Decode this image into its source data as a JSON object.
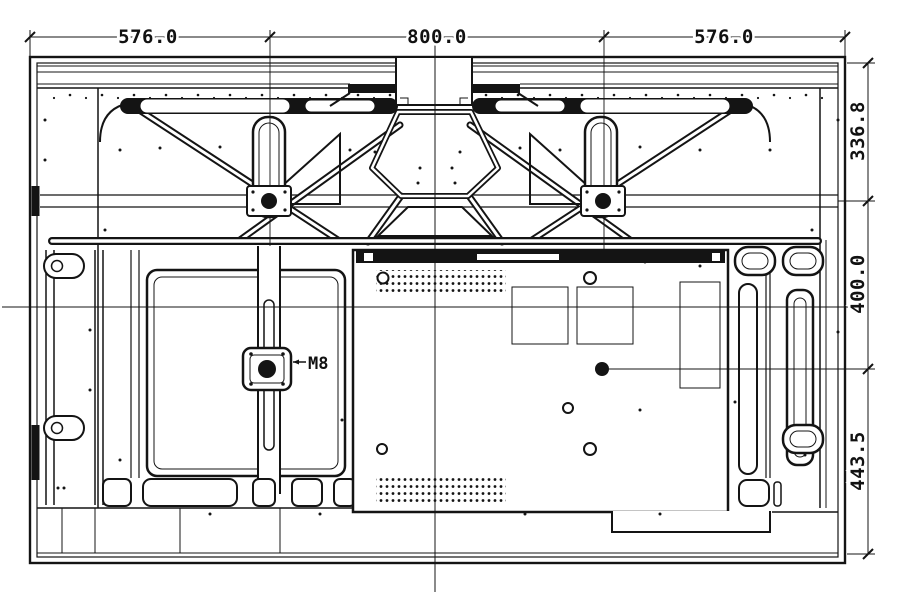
{
  "meta": {
    "type": "engineering-drawing",
    "subject": "flat-panel-display-rear-view-with-vesa-mount-dimensions",
    "ink_color": "#141414",
    "background_color": "#ffffff"
  },
  "dimensions": {
    "top": [
      {
        "label": "576.0"
      },
      {
        "label": "800.0"
      },
      {
        "label": "576.0"
      }
    ],
    "right": [
      {
        "label": "336.8"
      },
      {
        "label": "400.0"
      },
      {
        "label": "443.5"
      }
    ]
  },
  "annotations": {
    "mount_thread": "M8"
  }
}
